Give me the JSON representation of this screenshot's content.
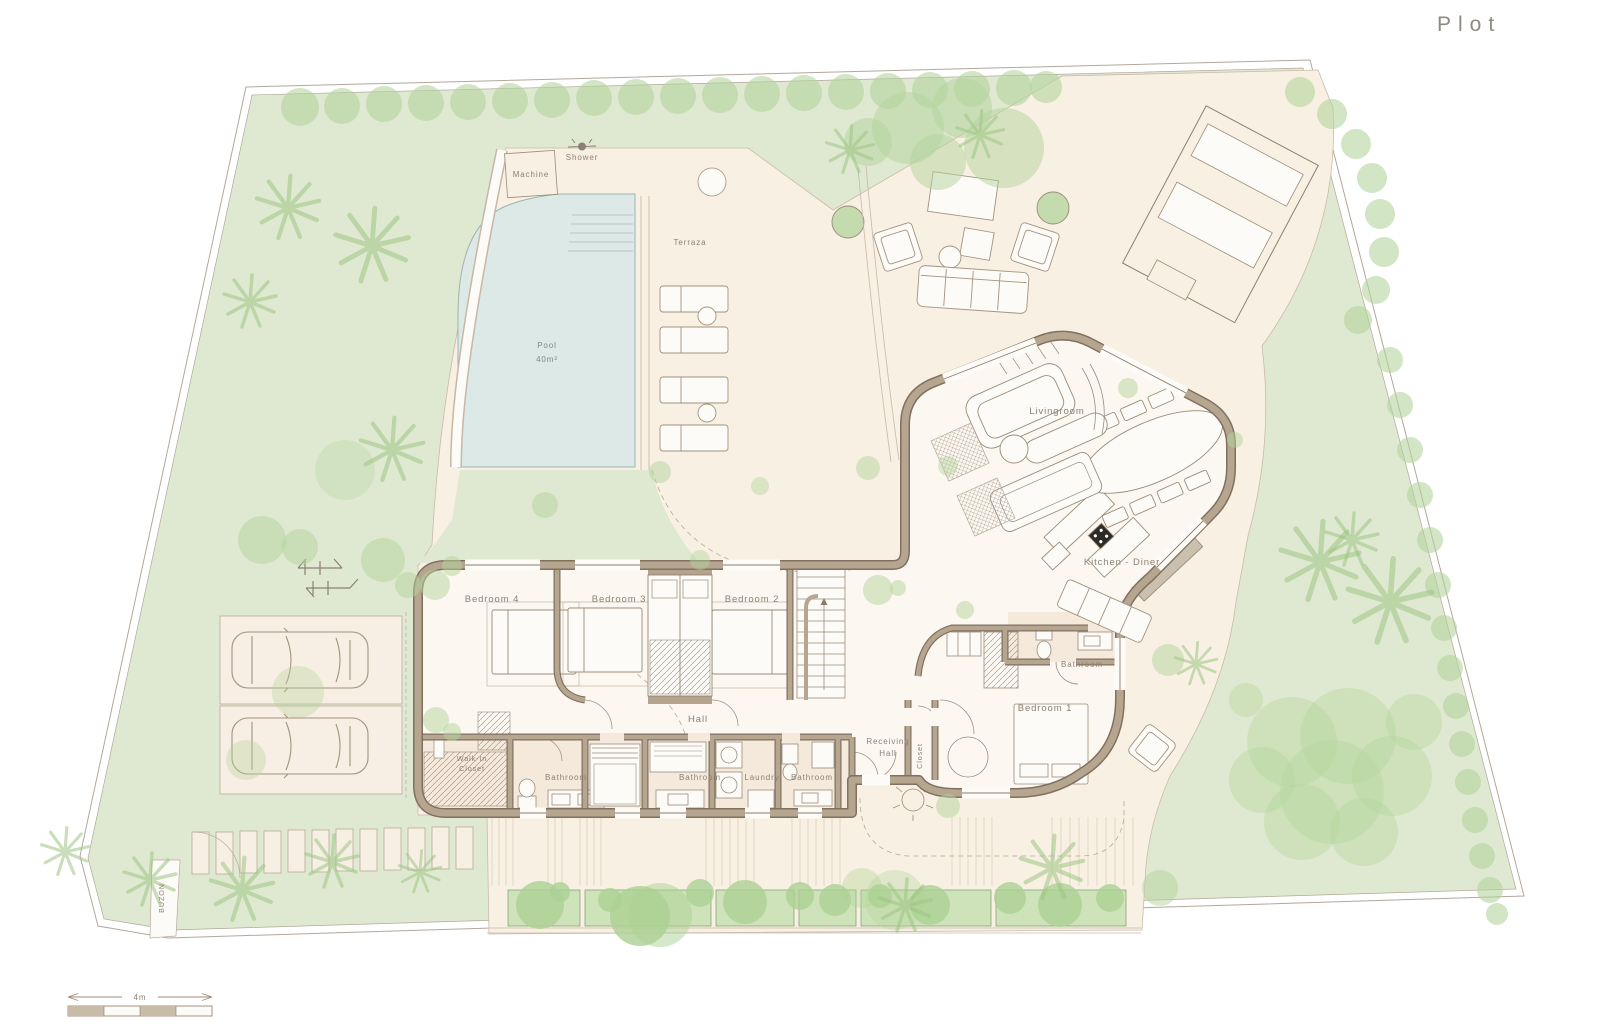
{
  "title": "Plot",
  "site": {
    "machine": "Machine",
    "shower": "Shower",
    "terraza": "Terraza",
    "pool_name": "Pool",
    "pool_area": "40m²",
    "buzon": "BUZON"
  },
  "rooms": {
    "livingroom": "Livingroom",
    "kitchen_diner": "Kitchen - Diner",
    "bedroom1": "Bedroom 1",
    "bedroom2": "Bedroom 2",
    "bedroom3": "Bedroom 3",
    "bedroom4": "Bedroom 4",
    "hall": "Hall",
    "walkin_1": "Walk-In",
    "walkin_2": "Closet",
    "bathroom_a": "Bathroom",
    "bathroom_b": "Bathroom",
    "bathroom_c": "Bathroom",
    "bathroom_d": "Bathroom",
    "laundry": "Laundry",
    "receiving_1": "Receiving",
    "receiving_2": "Hall",
    "closet": "Closet"
  },
  "scale": {
    "length_label": "4m"
  },
  "colors": {
    "lawn": "#dfe9d1",
    "hardscape": "#f8f0e2",
    "pool": "#dce9e6",
    "wall": "#b4a48e",
    "wall_dark": "#7f7060",
    "tree": "#b4d49c",
    "label_text": "#8c8074",
    "title_text": "#8e8983"
  }
}
